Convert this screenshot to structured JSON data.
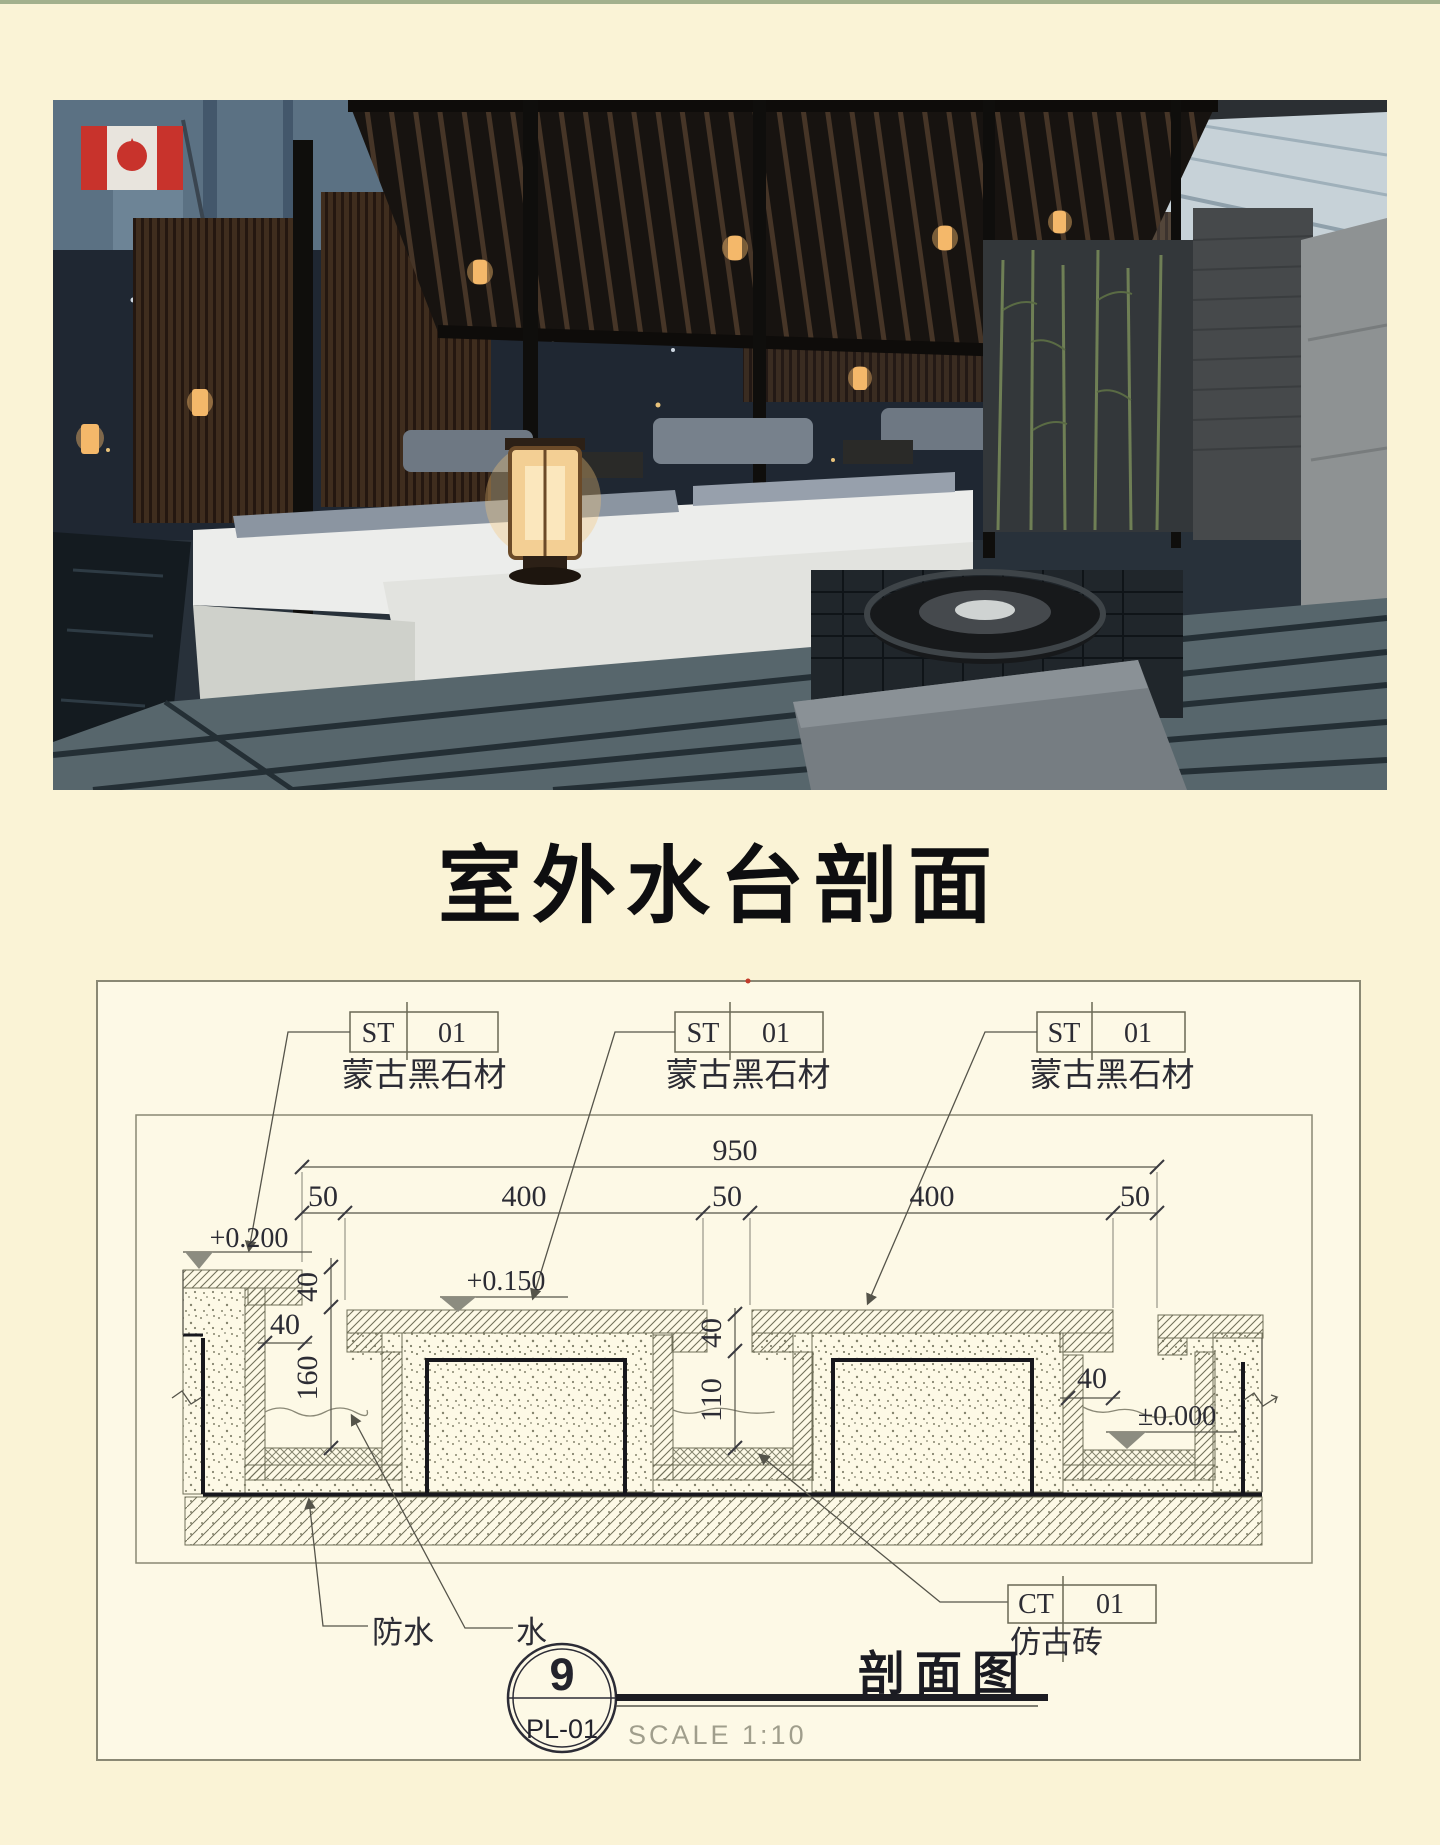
{
  "page": {
    "title": "室外水台剖面"
  },
  "drawing": {
    "stone_tags": [
      {
        "code": "ST",
        "num": "01",
        "material": "蒙古黑石材"
      },
      {
        "code": "ST",
        "num": "01",
        "material": "蒙古黑石材"
      },
      {
        "code": "ST",
        "num": "01",
        "material": "蒙古黑石材"
      }
    ],
    "tile_tag": {
      "code": "CT",
      "num": "01",
      "material": "仿古砖"
    },
    "dims": {
      "total": "950",
      "seg1": "50",
      "seg2": "400",
      "seg3": "50",
      "seg4": "400",
      "seg5": "50",
      "coping_thickness": "40",
      "channel1_depth": "160",
      "wall_width": "40",
      "slab_thickness": "40",
      "channel2_depth": "110",
      "channel3_wall": "40"
    },
    "levels": {
      "left": "+0.200",
      "middle": "+0.150",
      "right": "±0.000"
    },
    "annotations": {
      "waterproof": "防水",
      "water": "水"
    },
    "callout": {
      "number": "9",
      "sheet": "PL-01",
      "scale": "SCALE 1:10",
      "name": "剖面图"
    }
  }
}
